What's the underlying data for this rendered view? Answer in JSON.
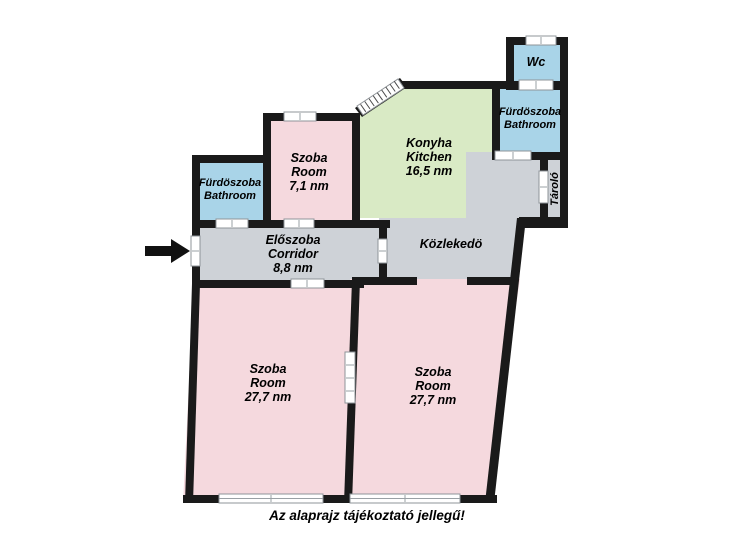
{
  "caption": "Az alaprajz tájékoztató jellegű!",
  "rooms": {
    "wc": {
      "name": "Wc"
    },
    "bathroom_right": {
      "name": "Fürdöszoba",
      "name_en": "Bathroom"
    },
    "storage": {
      "name": "Tároló"
    },
    "kitchen": {
      "name": "Konyha",
      "name_en": "Kitchen",
      "area": "16,5 nm"
    },
    "small_room": {
      "name": "Szoba",
      "name_en": "Room",
      "area": "7,1 nm"
    },
    "bathroom_left": {
      "name": "Fürdöszoba",
      "name_en": "Bathroom"
    },
    "corridor": {
      "name": "Előszoba",
      "name_en": "Corridor",
      "area": "8,8 nm"
    },
    "hallway": {
      "name": "Közlekedö"
    },
    "room_left": {
      "name": "Szoba",
      "name_en": "Room",
      "area": "27,7 nm"
    },
    "room_right": {
      "name": "Szoba",
      "name_en": "Room",
      "area": "27,7 nm"
    }
  },
  "colors": {
    "wall": "#1a1a1a",
    "room_pink": "#f5d9de",
    "kitchen_green": "#d9eac5",
    "bathroom_blue": "#a9d4e8",
    "corridor_gray": "#ced2d7",
    "background": "#ffffff",
    "arrow_black": "#111111"
  }
}
